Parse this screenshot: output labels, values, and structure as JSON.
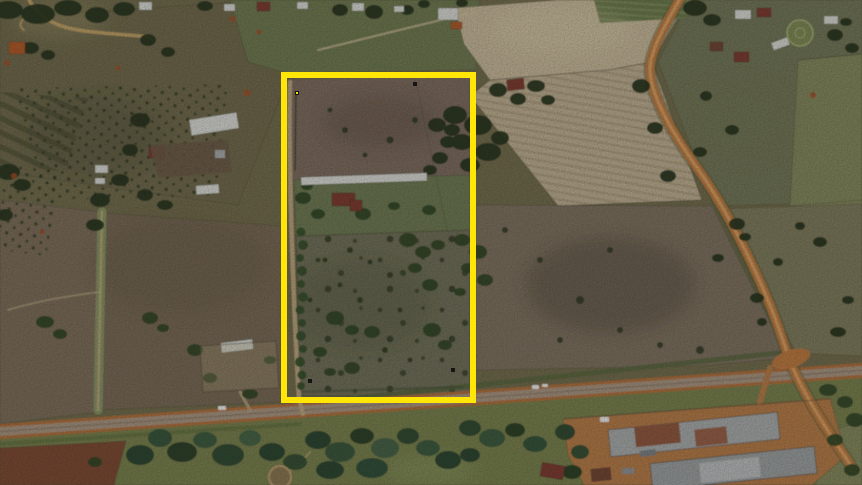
{
  "view": {
    "kind": "satellite-aerial-imagery",
    "width_px": 862,
    "height_px": 485
  },
  "overlay": {
    "boundary": {
      "x": "284",
      "y": "75",
      "width": "189",
      "height": "325",
      "stroke": "#ffe606",
      "stroke_width": "6"
    },
    "marker_color": "#171513",
    "marker_dot_color": "#ffe606",
    "markers": [
      {
        "x": "295",
        "y": "91"
      },
      {
        "x": "413",
        "y": "82"
      },
      {
        "x": "308",
        "y": "379"
      },
      {
        "x": "451",
        "y": "368"
      }
    ]
  },
  "palette": {
    "base": "#716d4f",
    "field_top_left": "#6f6b4f",
    "field_left_mid": "#7b6e5c",
    "field_center_left": "#776a58",
    "green_strip": "#6e7a52",
    "tan_field": "#c6b99c",
    "tan_field_rows": "#beb095",
    "field_right_top": "#72775a",
    "field_mid_right": "#7d7262",
    "pasture_right": "#7e7b5e",
    "pasture_far_right": "#83895f",
    "box_field_upper": "#7b6c60",
    "box_lawn": "#6d7a55",
    "box_field_lower": "#6f705b",
    "south_grass": "#77814f",
    "red_field": "#7b4a34",
    "yard_dirt": "#b57c49",
    "road_dirt": "#bd7a43",
    "road_dirt_center": "#daa468",
    "road_edge": "#b06f3c",
    "road_surface": "#a89583",
    "road_median": "#857868",
    "track": "#bda883",
    "lane_green": "#8a9a68",
    "hedge_green": "#57663f",
    "tree_dark": "#26341f",
    "tree_mid": "#2f4426",
    "tree_row": "#35502c",
    "tree_teal": "#35543c",
    "roof_white": "#d9dbd8",
    "roof_red": "#7c3b30",
    "roof_orange": "#b05a2a",
    "roof_gray": "#a7acae",
    "roof_rust": "#8e5940",
    "vehicle_white": "#eceff0",
    "soil_red_spot": "#a14e28"
  }
}
